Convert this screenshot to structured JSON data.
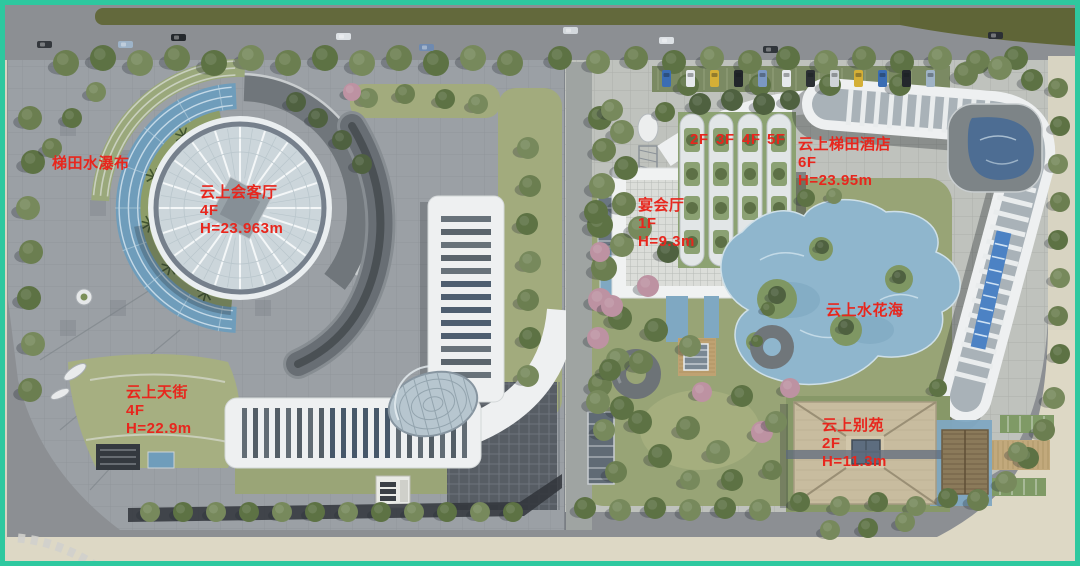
{
  "image": {
    "type": "aerial architectural site plan rendering",
    "border_color": "#2ec89f",
    "label_color": "#e8261d"
  },
  "labels": {
    "terraced_waterfall": {
      "text": "梯田水瀑布"
    },
    "cloud_reception_hall": {
      "text": "云上会客厅",
      "floors": "4F",
      "height": "H=23.963m"
    },
    "cloud_sky_street": {
      "text": "云上天街",
      "floors": "4F",
      "height": "H=22.9m"
    },
    "banquet_hall": {
      "text": "宴会厅",
      "floors": "1F",
      "height": "H=9.3m"
    },
    "cloud_terrace_hotel": {
      "text": "云上梯田酒店",
      "floors": "6F",
      "height": "H=23.95m"
    },
    "hotel_wing_floors": [
      "2F",
      "3F",
      "4F",
      "5F"
    ],
    "cloud_water_flower_sea": {
      "text": "云上水花海"
    },
    "cloud_villa": {
      "text": "云上别苑",
      "floors": "2F",
      "height": "H=11.3m"
    }
  }
}
